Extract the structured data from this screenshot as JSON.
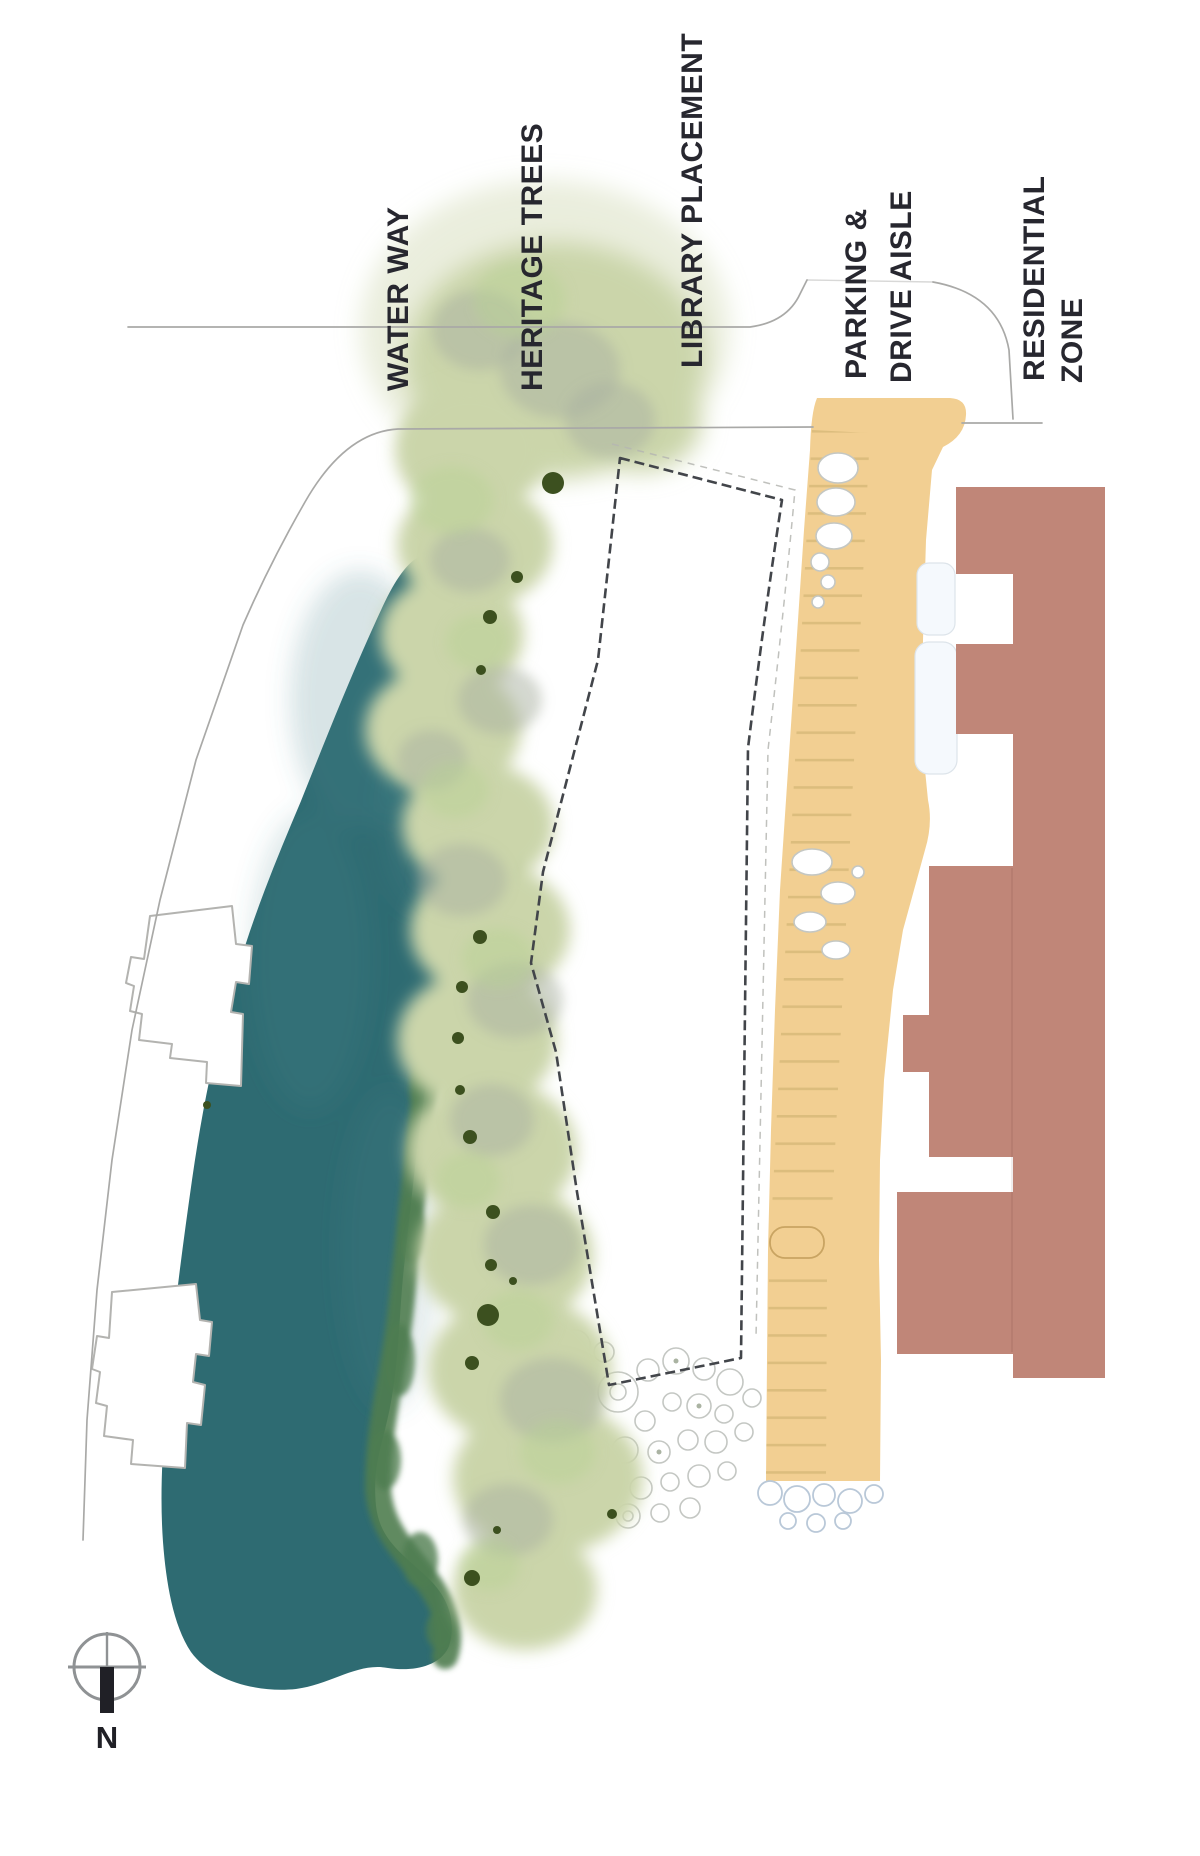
{
  "plan_type": "landscape site plan",
  "labels": {
    "water_way": "WATER WAY",
    "heritage_trees": "HERITAGE TREES",
    "library_placement": "LIBRARY PLACEMENT",
    "parking_line1": "PARKING &",
    "parking_line2": "DRIVE AISLE",
    "residential_line1": "RESIDENTIAL",
    "residential_line2": "ZONE"
  },
  "compass": {
    "north_label": "N"
  },
  "colors": {
    "water": "#2E6B72",
    "water_light": "#4B858C",
    "riparian": "#4F7D50",
    "canopy": "#CBD5AA",
    "canopy_shadow": "#A9B1A2",
    "canopy_bright": "#B9D194",
    "tree_dot": "#3C501F",
    "parking": "#F2CF92",
    "stall_line": "#DCBD7D",
    "residential": "#C08678",
    "label_text": "#27272F",
    "outline_dark": "#42454A",
    "line_gray": "#A9A9A7",
    "shrub_gray": "#C4C7C3",
    "shrub_blue": "#B9C8D8",
    "building_outline": "#B3B3B0",
    "compass": "#8F9294",
    "compass_dark": "#202026"
  }
}
